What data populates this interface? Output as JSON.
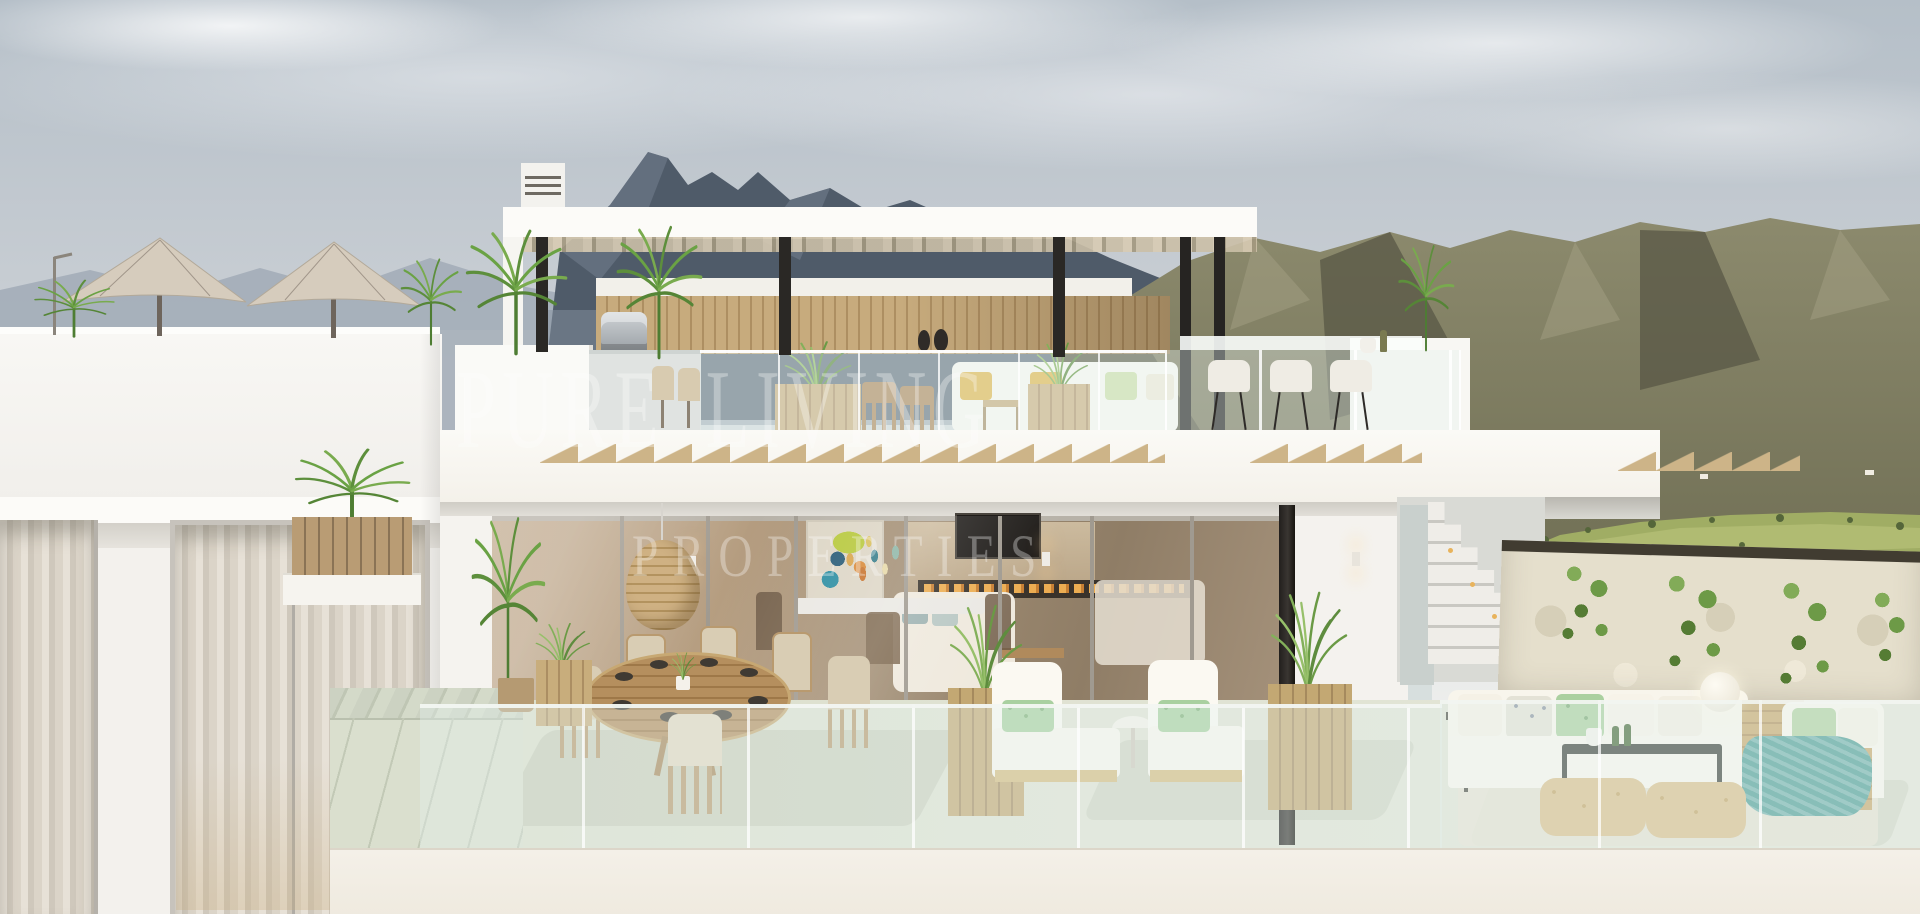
{
  "scene": {
    "type": "architectural-exterior-render",
    "subject": "Modern two-storey white villa with rooftop pergola terrace, outdoor dining and lounge terraces, overlooking mountains and a green golf valley"
  },
  "watermark": {
    "line1": "PURE LIVING",
    "line2": "PROPERTIES",
    "color": "#ffffff",
    "opacity": 0.32
  },
  "palette": {
    "sky_top": "#b5bfc8",
    "sky_bottom": "#edeeec",
    "mountain_haze": "#a3adb8",
    "mountain_peak": "#4f5b69",
    "mountain_right_light": "#8c8a6d",
    "mountain_right_dark": "#6d6c52",
    "valley_green": "#a0ad64",
    "villa_white": "#f7f5f1",
    "shadow_white": "#d3d0c9",
    "wood_cladding": "#b89e7b",
    "wood_furniture": "#c9ae7e",
    "terrace_floor": "#dce0cf",
    "glass_tint": "#e6efee",
    "steel_black": "#2a2825",
    "parasol_beige": "#d6ccbd",
    "cushion_yellow": "#e3b94f",
    "cushion_green": "#a9d0a0",
    "throw_teal": "#4f9e97",
    "ivy_green": "#6f9c4a",
    "flame_amber": "#e9a94f",
    "stone_wall": "#e5dfcc"
  }
}
